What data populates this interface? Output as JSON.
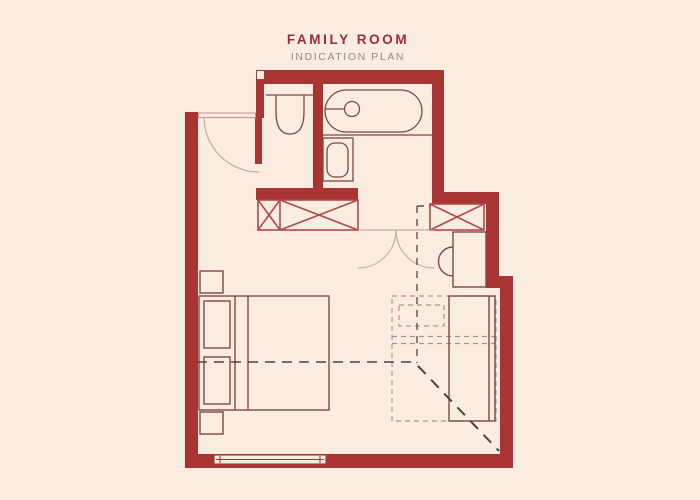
{
  "header": {
    "title": "FAMILY ROOM",
    "subtitle": "INDICATION PLAN"
  },
  "palette": {
    "background": "#fbece2",
    "wall_red": "#a93434",
    "furniture_line": "#7c4a43",
    "wardrobe_red": "#b04a46",
    "door_swing": "#c9a89e",
    "dash_dark": "#53403c",
    "dash_light": "#c08a84",
    "title_red": "#a12a38",
    "subtitle_gray": "#8c8c8c"
  },
  "plan": {
    "rooms": [
      "entry-vestibule",
      "wc-room",
      "bathtub-room",
      "bedroom"
    ],
    "elements": [
      "entry-door",
      "wc-toilet",
      "bathtub",
      "bathtub-drain",
      "vanity-sink",
      "wardrobe-left",
      "wardrobe-right",
      "double-doors",
      "desk",
      "desk-chair",
      "double-bed",
      "pillows",
      "nightstands",
      "sofa-bed",
      "sofa-bed-foldout-dashed",
      "bed-centerline-dashed",
      "foldout-direction-diagonal",
      "window"
    ]
  }
}
